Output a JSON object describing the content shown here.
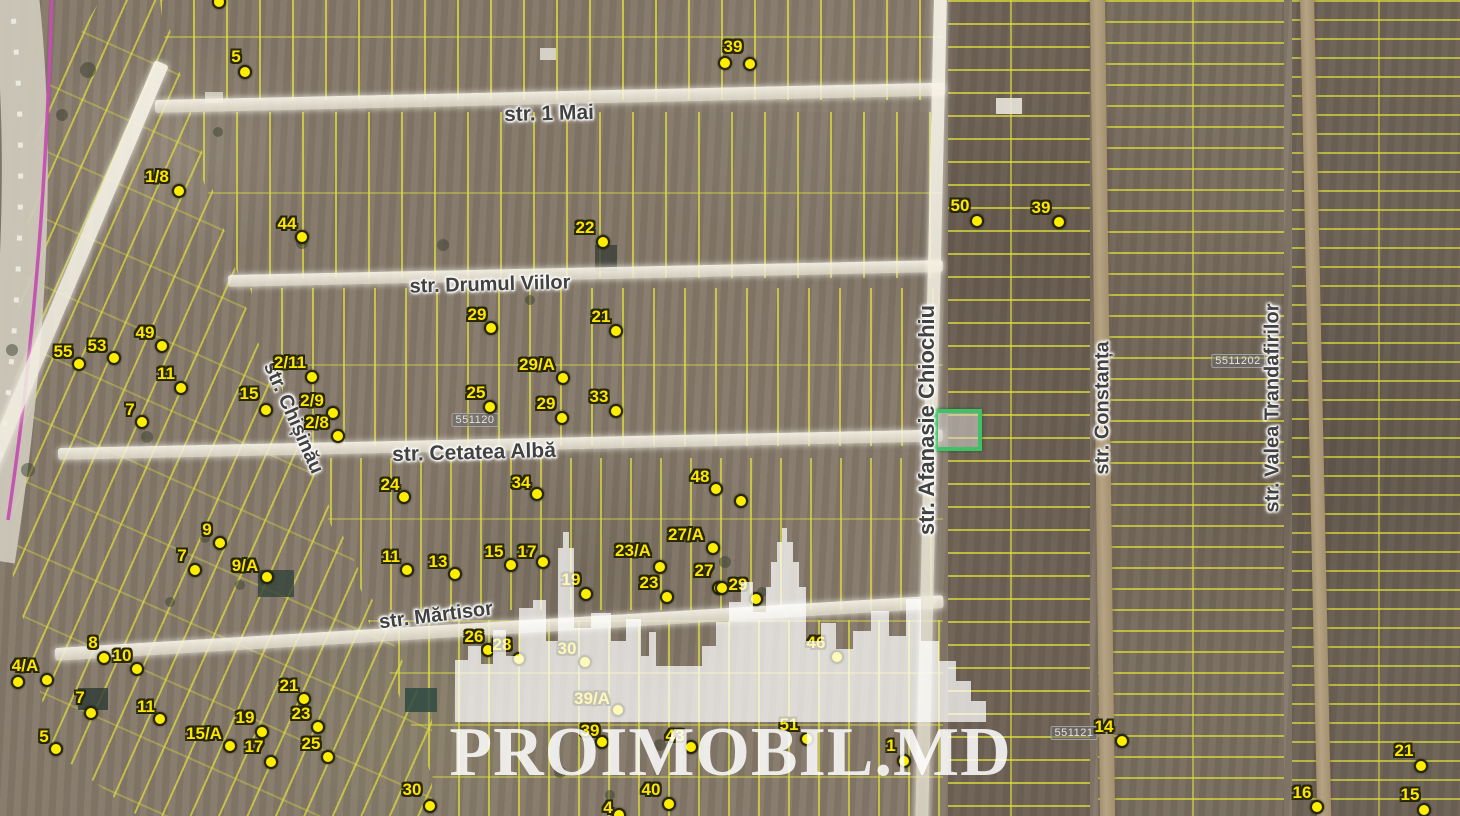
{
  "map": {
    "watermark": {
      "text": "PROIMOBIL.MD"
    },
    "selected_parcel": {
      "x": 934,
      "y": 409,
      "w": 40,
      "h": 34,
      "color": "#3fc267"
    },
    "streets": [
      {
        "name": "str. 1 Mai",
        "x": 549,
        "y": 114,
        "rotate": -1.5,
        "size": 21
      },
      {
        "name": "str. Drumul Viilor",
        "x": 490,
        "y": 285,
        "rotate": -1.5,
        "size": 20
      },
      {
        "name": "str. Cetatea Albă",
        "x": 474,
        "y": 453,
        "rotate": -1.5,
        "size": 21
      },
      {
        "name": "str. Chișinău",
        "x": 293,
        "y": 418,
        "rotate": 66,
        "size": 20
      },
      {
        "name": "str. Mărtisor",
        "x": 436,
        "y": 616,
        "rotate": -7,
        "size": 20
      },
      {
        "name": "str. Afanasie Chiochiu",
        "x": 927,
        "y": 420,
        "rotate": -90,
        "size": 22
      },
      {
        "name": "str. Constanța",
        "x": 1103,
        "y": 408,
        "rotate": -90,
        "size": 20
      },
      {
        "name": "str. Valea Trandafirilor",
        "x": 1273,
        "y": 408,
        "rotate": -90,
        "size": 20
      }
    ],
    "cadastral_labels": [
      {
        "text": "551120",
        "x": 475,
        "y": 420
      },
      {
        "text": "5511202",
        "x": 1238,
        "y": 361
      },
      {
        "text": "551121",
        "x": 1074,
        "y": 733
      }
    ],
    "markers": [
      {
        "label": "5",
        "lx": 236,
        "ly": 57,
        "dots": [
          [
            245,
            72
          ]
        ]
      },
      {
        "label": "",
        "lx": 219,
        "ly": 2,
        "dots": [
          [
            219,
            2
          ]
        ]
      },
      {
        "label": "39",
        "lx": 733,
        "ly": 47,
        "dots": [
          [
            725,
            63
          ],
          [
            750,
            64
          ]
        ]
      },
      {
        "label": "1/8",
        "lx": 157,
        "ly": 177,
        "dots": [
          [
            179,
            191
          ]
        ]
      },
      {
        "label": "44",
        "lx": 287,
        "ly": 224,
        "dots": [
          [
            302,
            237
          ]
        ]
      },
      {
        "label": "22",
        "lx": 585,
        "ly": 228,
        "dots": [
          [
            603,
            242
          ]
        ]
      },
      {
        "label": "50",
        "lx": 960,
        "ly": 206,
        "dots": [
          [
            977,
            221
          ]
        ]
      },
      {
        "label": "39",
        "lx": 1041,
        "ly": 208,
        "dots": [
          [
            1059,
            222
          ]
        ]
      },
      {
        "label": "29",
        "lx": 477,
        "ly": 315,
        "dots": [
          [
            491,
            328
          ]
        ]
      },
      {
        "label": "21",
        "lx": 601,
        "ly": 317,
        "dots": [
          [
            616,
            331
          ]
        ]
      },
      {
        "label": "29/A",
        "lx": 537,
        "ly": 365,
        "dots": [
          [
            563,
            378
          ]
        ]
      },
      {
        "label": "25",
        "lx": 476,
        "ly": 393,
        "dots": [
          [
            490,
            407
          ]
        ]
      },
      {
        "label": "29",
        "lx": 546,
        "ly": 404,
        "dots": [
          [
            562,
            418
          ]
        ]
      },
      {
        "label": "33",
        "lx": 599,
        "ly": 397,
        "dots": [
          [
            616,
            411
          ]
        ]
      },
      {
        "label": "55",
        "lx": 63,
        "ly": 352,
        "dots": [
          [
            79,
            364
          ]
        ]
      },
      {
        "label": "53",
        "lx": 97,
        "ly": 346,
        "dots": [
          [
            114,
            358
          ]
        ]
      },
      {
        "label": "49",
        "lx": 145,
        "ly": 333,
        "dots": [
          [
            162,
            346
          ]
        ]
      },
      {
        "label": "11",
        "lx": 166,
        "ly": 374,
        "dots": [
          [
            181,
            388
          ]
        ]
      },
      {
        "label": "7",
        "lx": 130,
        "ly": 410,
        "dots": [
          [
            142,
            422
          ]
        ]
      },
      {
        "label": "15",
        "lx": 249,
        "ly": 394,
        "dots": [
          [
            266,
            410
          ]
        ]
      },
      {
        "label": "2/11",
        "lx": 290,
        "ly": 363,
        "dots": [
          [
            312,
            377
          ]
        ]
      },
      {
        "label": "2/9",
        "lx": 312,
        "ly": 401,
        "dots": [
          [
            333,
            413
          ]
        ]
      },
      {
        "label": "2/8",
        "lx": 317,
        "ly": 423,
        "dots": [
          [
            338,
            436
          ]
        ]
      },
      {
        "label": "24",
        "lx": 390,
        "ly": 485,
        "dots": [
          [
            404,
            497
          ]
        ]
      },
      {
        "label": "34",
        "lx": 521,
        "ly": 483,
        "dots": [
          [
            537,
            494
          ]
        ]
      },
      {
        "label": "48",
        "lx": 700,
        "ly": 477,
        "dots": [
          [
            716,
            489
          ],
          [
            741,
            501
          ]
        ]
      },
      {
        "label": "9",
        "lx": 207,
        "ly": 530,
        "dots": [
          [
            220,
            543
          ]
        ]
      },
      {
        "label": "7",
        "lx": 182,
        "ly": 556,
        "dots": [
          [
            195,
            570
          ]
        ]
      },
      {
        "label": "9/A",
        "lx": 245,
        "ly": 566,
        "dots": [
          [
            267,
            577
          ]
        ]
      },
      {
        "label": "27/A",
        "lx": 686,
        "ly": 535,
        "dots": [
          [
            713,
            548
          ]
        ]
      },
      {
        "label": "23/A",
        "lx": 633,
        "ly": 551,
        "dots": [
          [
            660,
            567
          ]
        ]
      },
      {
        "label": "23",
        "lx": 649,
        "ly": 583,
        "dots": [
          [
            667,
            597
          ]
        ]
      },
      {
        "label": "27",
        "lx": 704,
        "ly": 571,
        "dots": [
          [
            719,
            588
          ]
        ]
      },
      {
        "label": "29",
        "lx": 738,
        "ly": 585,
        "dots": [
          [
            722,
            588
          ],
          [
            756,
            599
          ]
        ]
      },
      {
        "label": "11",
        "lx": 391,
        "ly": 557,
        "dots": [
          [
            407,
            570
          ]
        ]
      },
      {
        "label": "13",
        "lx": 438,
        "ly": 562,
        "dots": [
          [
            455,
            574
          ]
        ]
      },
      {
        "label": "15",
        "lx": 494,
        "ly": 552,
        "dots": [
          [
            511,
            565
          ]
        ]
      },
      {
        "label": "17",
        "lx": 527,
        "ly": 552,
        "dots": [
          [
            543,
            562
          ]
        ]
      },
      {
        "label": "19",
        "lx": 571,
        "ly": 580,
        "dots": [
          [
            586,
            594
          ]
        ]
      },
      {
        "label": "8",
        "lx": 93,
        "ly": 643,
        "dots": [
          [
            104,
            658
          ]
        ]
      },
      {
        "label": "10",
        "lx": 122,
        "ly": 656,
        "dots": [
          [
            137,
            669
          ]
        ]
      },
      {
        "label": "4/A",
        "lx": 25,
        "ly": 666,
        "dots": [
          [
            18,
            682
          ],
          [
            47,
            680
          ]
        ]
      },
      {
        "label": "7",
        "lx": 80,
        "ly": 698,
        "dots": [
          [
            91,
            713
          ]
        ]
      },
      {
        "label": "5",
        "lx": 44,
        "ly": 737,
        "dots": [
          [
            56,
            749
          ]
        ]
      },
      {
        "label": "11",
        "lx": 146,
        "ly": 707,
        "dots": [
          [
            160,
            719
          ]
        ]
      },
      {
        "label": "15/A",
        "lx": 204,
        "ly": 734,
        "dots": [
          [
            230,
            746
          ]
        ]
      },
      {
        "label": "19",
        "lx": 245,
        "ly": 718,
        "dots": [
          [
            262,
            732
          ]
        ]
      },
      {
        "label": "17",
        "lx": 254,
        "ly": 747,
        "dots": [
          [
            271,
            762
          ]
        ]
      },
      {
        "label": "21",
        "lx": 289,
        "ly": 686,
        "dots": [
          [
            304,
            699
          ]
        ]
      },
      {
        "label": "23",
        "lx": 301,
        "ly": 714,
        "dots": [
          [
            318,
            727
          ]
        ]
      },
      {
        "label": "25",
        "lx": 311,
        "ly": 744,
        "dots": [
          [
            328,
            757
          ]
        ]
      },
      {
        "label": "26",
        "lx": 474,
        "ly": 637,
        "dots": [
          [
            488,
            650
          ]
        ]
      },
      {
        "label": "28",
        "lx": 502,
        "ly": 645,
        "dots": [
          [
            519,
            659
          ]
        ]
      },
      {
        "label": "30",
        "lx": 567,
        "ly": 649,
        "dots": [
          [
            585,
            662
          ]
        ]
      },
      {
        "label": "39/A",
        "lx": 592,
        "ly": 699,
        "dots": [
          [
            618,
            710
          ]
        ]
      },
      {
        "label": "39",
        "lx": 590,
        "ly": 731,
        "dots": [
          [
            602,
            742
          ]
        ]
      },
      {
        "label": "43",
        "lx": 675,
        "ly": 736,
        "dots": [
          [
            691,
            747
          ]
        ]
      },
      {
        "label": "40",
        "lx": 651,
        "ly": 790,
        "dots": [
          [
            669,
            804
          ]
        ]
      },
      {
        "label": "4",
        "lx": 608,
        "ly": 808,
        "dots": [
          [
            619,
            815
          ]
        ]
      },
      {
        "label": "30",
        "lx": 412,
        "ly": 790,
        "dots": [
          [
            430,
            806
          ]
        ]
      },
      {
        "label": "46",
        "lx": 816,
        "ly": 643,
        "dots": [
          [
            837,
            657
          ]
        ]
      },
      {
        "label": "51",
        "lx": 789,
        "ly": 725,
        "dots": [
          [
            807,
            739
          ]
        ]
      },
      {
        "label": "1",
        "lx": 891,
        "ly": 746,
        "dots": [
          [
            904,
            761
          ]
        ]
      },
      {
        "label": "14",
        "lx": 1104,
        "ly": 727,
        "dots": [
          [
            1122,
            741
          ]
        ]
      },
      {
        "label": "21",
        "lx": 1404,
        "ly": 751,
        "dots": [
          [
            1421,
            766
          ]
        ]
      },
      {
        "label": "16",
        "lx": 1302,
        "ly": 793,
        "dots": [
          [
            1317,
            807
          ]
        ]
      },
      {
        "label": "15",
        "lx": 1410,
        "ly": 795,
        "dots": [
          [
            1424,
            810
          ]
        ]
      }
    ]
  }
}
